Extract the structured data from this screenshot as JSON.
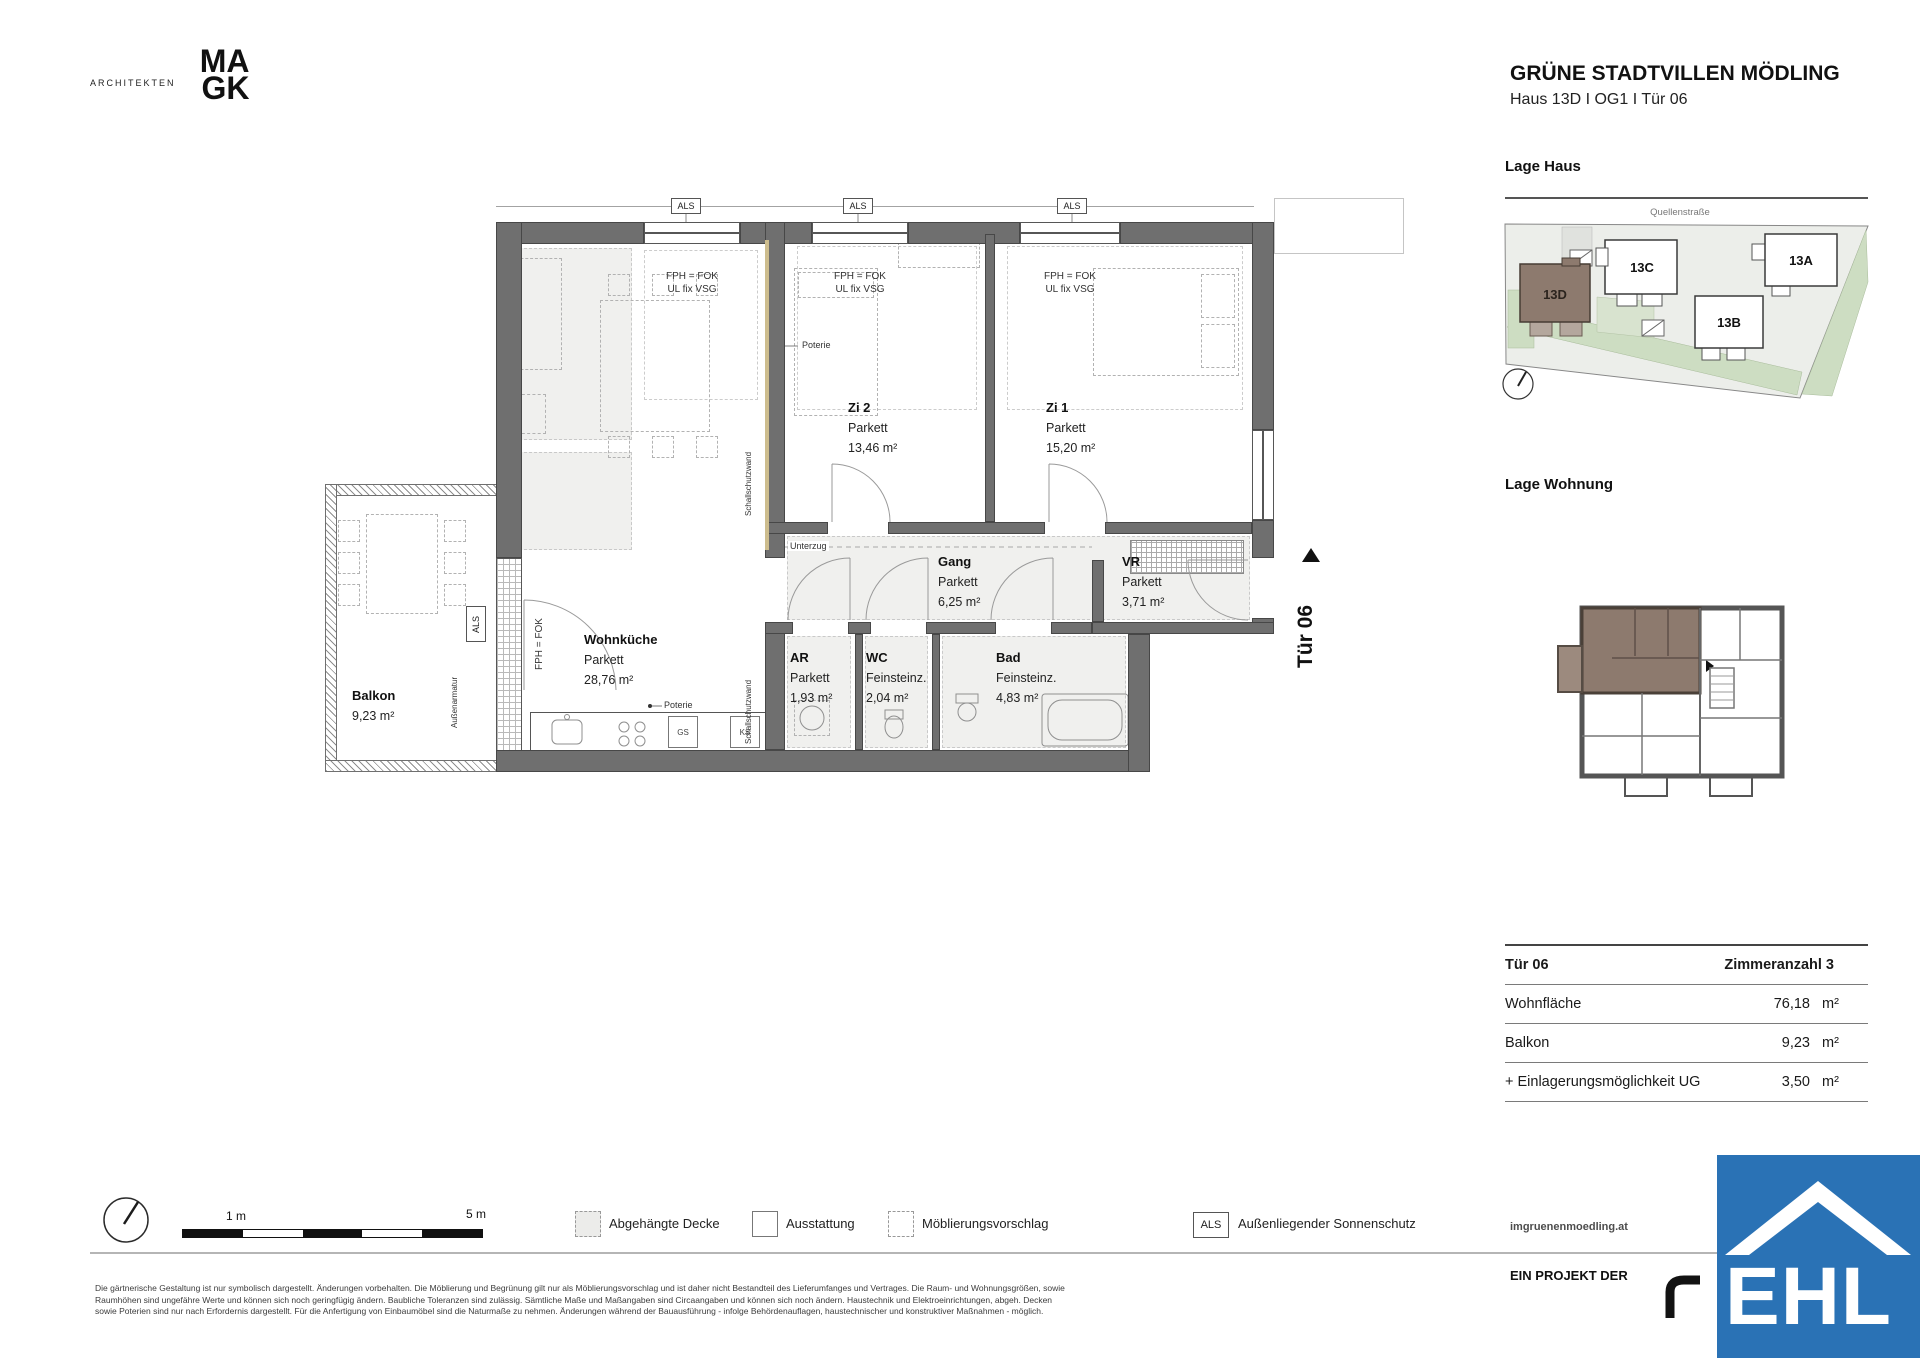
{
  "logo": {
    "architekten": "ARCHITEKTEN",
    "ma": "MA",
    "gk": "GK"
  },
  "title": {
    "main": "GRÜNE STADTVILLEN MÖDLING",
    "sub": "Haus 13D I OG1 I Tür 06"
  },
  "lage_haus": {
    "heading": "Lage Haus",
    "street": "Quellenstraße",
    "b13d": "13D",
    "b13c": "13C",
    "b13b": "13B",
    "b13a": "13A"
  },
  "lage_wohnung": {
    "heading": "Lage Wohnung"
  },
  "rooms": {
    "wohnkueche": {
      "name": "Wohnküche",
      "floor": "Parkett",
      "area": "28,76 m²"
    },
    "zi2": {
      "name": "Zi 2",
      "floor": "Parkett",
      "area": "13,46 m²"
    },
    "zi1": {
      "name": "Zi 1",
      "floor": "Parkett",
      "area": "15,20 m²"
    },
    "gang": {
      "name": "Gang",
      "floor": "Parkett",
      "area": "6,25 m²"
    },
    "vr": {
      "name": "VR",
      "floor": "Parkett",
      "area": "3,71 m²"
    },
    "ar": {
      "name": "AR",
      "floor": "Parkett",
      "area": "1,93 m²"
    },
    "wc": {
      "name": "WC",
      "floor": "Feinsteinz.",
      "area": "2,04 m²"
    },
    "bad": {
      "name": "Bad",
      "floor": "Feinsteinz.",
      "area": "4,83 m²"
    },
    "balkon": {
      "name": "Balkon",
      "area": "9,23 m²"
    }
  },
  "annotations": {
    "als": "ALS",
    "fph_fok": "FPH = FOK",
    "ul_fix": "UL fix VSG",
    "fph_fok_solo": "FPH = FOK",
    "poterie": "Poterie",
    "unterzug": "Unterzug",
    "aussenarmatur": "Außenarmatur",
    "wandlabel": "Schallschutzwand",
    "tuer_marker": "Tür 06",
    "gs": "GS",
    "ks": "KS"
  },
  "table": {
    "header_left": "Tür  06",
    "header_right": "Zimmeranzahl  3",
    "rows": [
      {
        "label": "Wohnfläche",
        "value": "76,18",
        "unit": "m²"
      },
      {
        "label": "Balkon",
        "value": "9,23",
        "unit": "m²"
      },
      {
        "label": "+ Einlagerungsmöglichkeit UG",
        "value": "3,50",
        "unit": "m²"
      }
    ]
  },
  "scalebar": {
    "m1": "1 m",
    "m5": "5 m"
  },
  "legend": {
    "abgehaengte": "Abgehängte Decke",
    "ausstattung": "Ausstattung",
    "moeblierung": "Möblierungsvorschlag",
    "als_box": "ALS",
    "sonnenschutz": "Außenliegender Sonnenschutz"
  },
  "footer": {
    "website": "imgruenenmoedling.at",
    "projekt": "EIN PROJEKT DER",
    "ehl": "EHL",
    "line1": "Die gärtnerische Gestaltung ist nur symbolisch dargestellt. Änderungen vorbehalten. Die Möblierung und Begrünung gilt nur als Möblierungsvorschlag und ist daher nicht Bestandteil des Lieferumfanges und Vertrages. Die Raum- und Wohnungsgrößen, sowie",
    "line2": "Raumhöhen sind ungefähre Werte und können sich noch geringfügig ändern. Baubliche Toleranzen sind zulässig. Sämtliche Maße und Maßangaben sind Circaangaben und können sich noch ändern. Haustechnik und Elektroeinrichtungen, abgeh. Decken",
    "line3": "sowie Poterien sind nur nach Erfordernis dargestellt. Für die Anfertigung von Einbaumöbel sind die Naturmaße zu nehmen. Änderungen während der Bauausführung - infolge Behördenauflagen, haustechnischer und konstruktiver Maßnahmen - möglich."
  },
  "colors": {
    "ehl_blue": "#2a72b5",
    "unit_brown": "#8d7a6e",
    "site_green": "#cdddc2",
    "wall_grey": "#6f6f6f"
  }
}
